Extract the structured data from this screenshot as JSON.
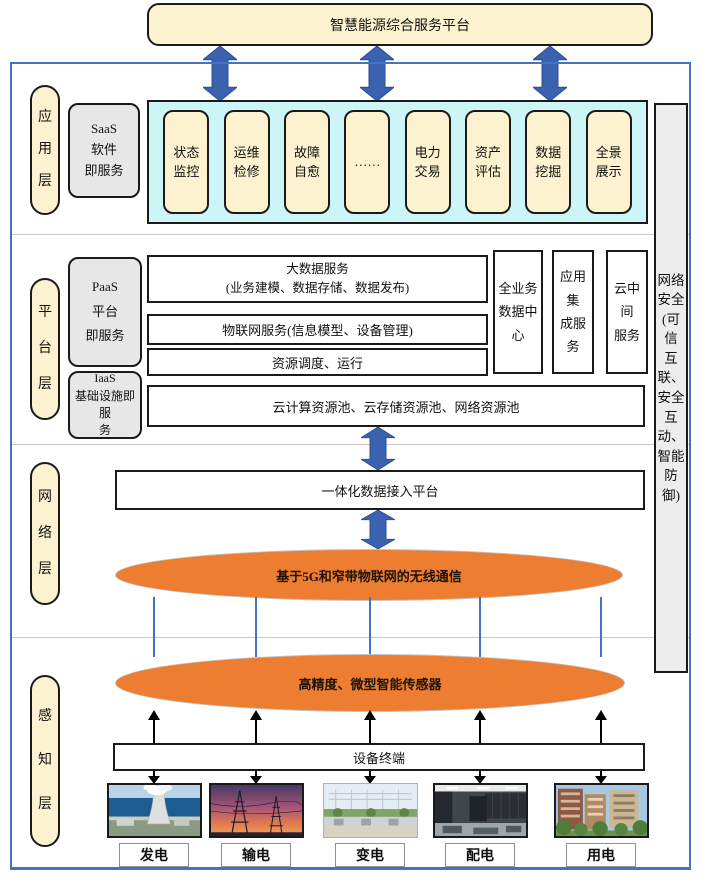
{
  "title": "智慧能源综合服务平台",
  "security_bar": "网络\n安全\n(可信\n互联、\n安全\n互动、\n智能\n防御)",
  "app_layer": {
    "label": "应\n用\n层",
    "saas": "SaaS\n软件\n即服务",
    "apps": [
      "状态\n监控",
      "运维\n检修",
      "故障\n自愈",
      "……",
      "电力\n交易",
      "资产\n评估",
      "数据\n挖掘",
      "全景\n展示"
    ]
  },
  "platform_layer": {
    "label": "平\n台\n层",
    "paas": "PaaS\n平台\n即服务",
    "iaas": "IaaS\n基础设施即服\n务",
    "bigdata": "大数据服务\n(业务建模、数据存储、数据发布)",
    "iot": "物联网服务(信息模型、设备管理)",
    "resource": "资源调度、运行",
    "cloud_pool": "云计算资源池、云存储资源池、网络资源池",
    "data_center": "全业务\n数据中\n心",
    "integration": "应用集\n成服务",
    "middleware": "云中间\n服务"
  },
  "network_layer": {
    "label": "网\n络\n层",
    "access_platform": "一体化数据接入平台",
    "wireless": "基于5G和窄带物联网的无线通信"
  },
  "perception_layer": {
    "label": "感\n知\n层",
    "sensor": "高精度、微型智能传感器",
    "terminal": "设备终端",
    "categories": [
      "发电",
      "输电",
      "变电",
      "配电",
      "用电"
    ]
  },
  "colors": {
    "cream": "#FCF2CF",
    "gray": "#E8E7E7",
    "cyan": "#CBF5F7",
    "orange": "#ED7D31",
    "arrow_blue": "#3A62AE",
    "frame_blue": "#4472C4"
  }
}
